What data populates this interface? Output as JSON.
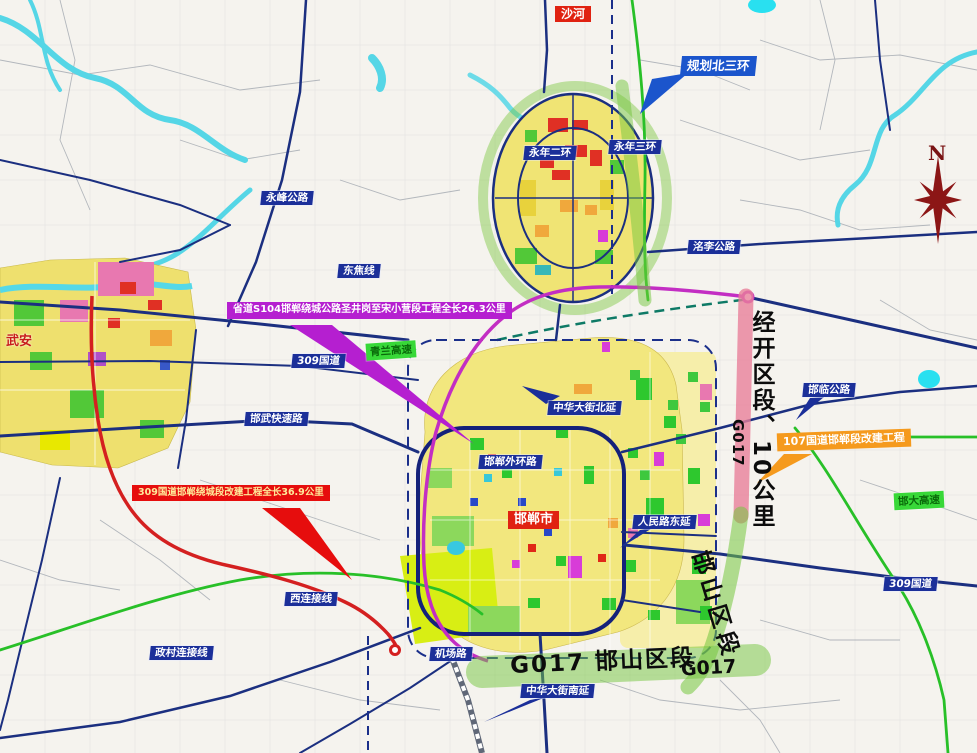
{
  "compass": {
    "letter": "N"
  },
  "city_labels": {
    "shahe": "沙河",
    "wuan": "武安",
    "handan": "邯郸市"
  },
  "callouts": {
    "north_ring": "规划北三环",
    "s104": "省道S104邯郸绕城公路圣井岗至宋小营段工程全长26.3公里",
    "g309": "309国道邯郸绕城段改建工程全长36.9公里",
    "g107": "107国道邯郸段改建工程"
  },
  "road_labels": {
    "yongfeng": "永峰公路",
    "dongjiao": "东焦线",
    "g309_west": "309国道",
    "hanwu": "邯武快速路",
    "zhonghua_north": "中华大街北延",
    "waihuan": "邯郸外环路",
    "renmin": "人民路东延",
    "jichang": "机场路",
    "zhengcun": "政村连接线",
    "xilianjie": "西连接线",
    "zhonghua_south": "中华大街南延",
    "hanlin": "邯临公路",
    "g309_east": "309国道",
    "mingli": "洺李公路",
    "yongnian_er": "永年二环",
    "yongnian_san": "永年三环"
  },
  "highway_labels": {
    "west": "青兰高速",
    "southeast": "邯大高速"
  },
  "segments": {
    "jingkai": "经开区段、10公里",
    "g017_vertical": "G017",
    "hanshan_diagonal": "邯山区段",
    "hanshan_bottom": "G017 邯山区段",
    "g017_bottom": "G017"
  },
  "colors": {
    "callout_purple": "#b51fd0",
    "callout_red": "#e60d0d",
    "callout_orange": "#f59a1d",
    "callout_blue": "#1b55cc",
    "road_label_bg": "#1b2f99",
    "corridor_green": "#74c63e",
    "corridor_pink": "#e87f9a",
    "route_purple": "#c32ec3",
    "route_red": "#d42020",
    "place_label_red": "#e02211"
  }
}
